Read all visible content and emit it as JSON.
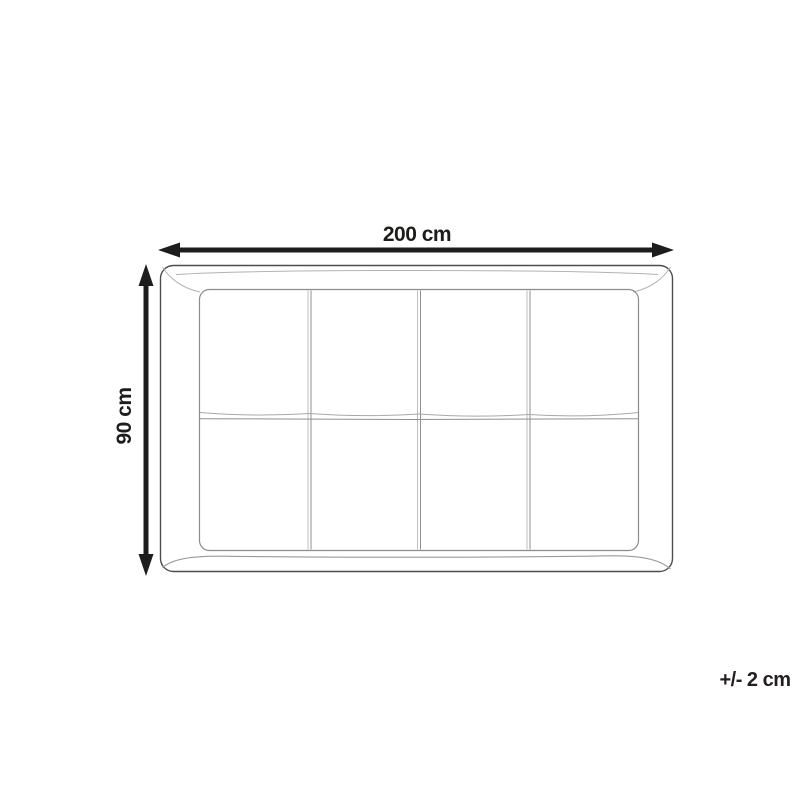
{
  "diagram": {
    "type": "product-dimension-diagram",
    "description": "Top-view line drawing of an upholstered headboard with a 4x2 grid of padded panels",
    "grid": {
      "columns": 4,
      "rows": 2,
      "panels": 8
    },
    "width_dimension": {
      "label": "200 cm",
      "value": 200,
      "unit": "cm"
    },
    "height_dimension": {
      "label": "90 cm",
      "value": 90,
      "unit": "cm"
    },
    "tolerance": {
      "label": "+/- 2 cm",
      "value": 2,
      "unit": "cm"
    },
    "icons": {
      "width_arrow": "double-headed-horizontal-arrow",
      "height_arrow": "double-headed-vertical-arrow"
    },
    "colors": {
      "background": "#ffffff",
      "arrow_and_text": "#1d1d1b",
      "outline_dark": "#4d4d4d",
      "outline_mid": "#8c8c8c",
      "outline_light": "#b2b2b2"
    }
  }
}
